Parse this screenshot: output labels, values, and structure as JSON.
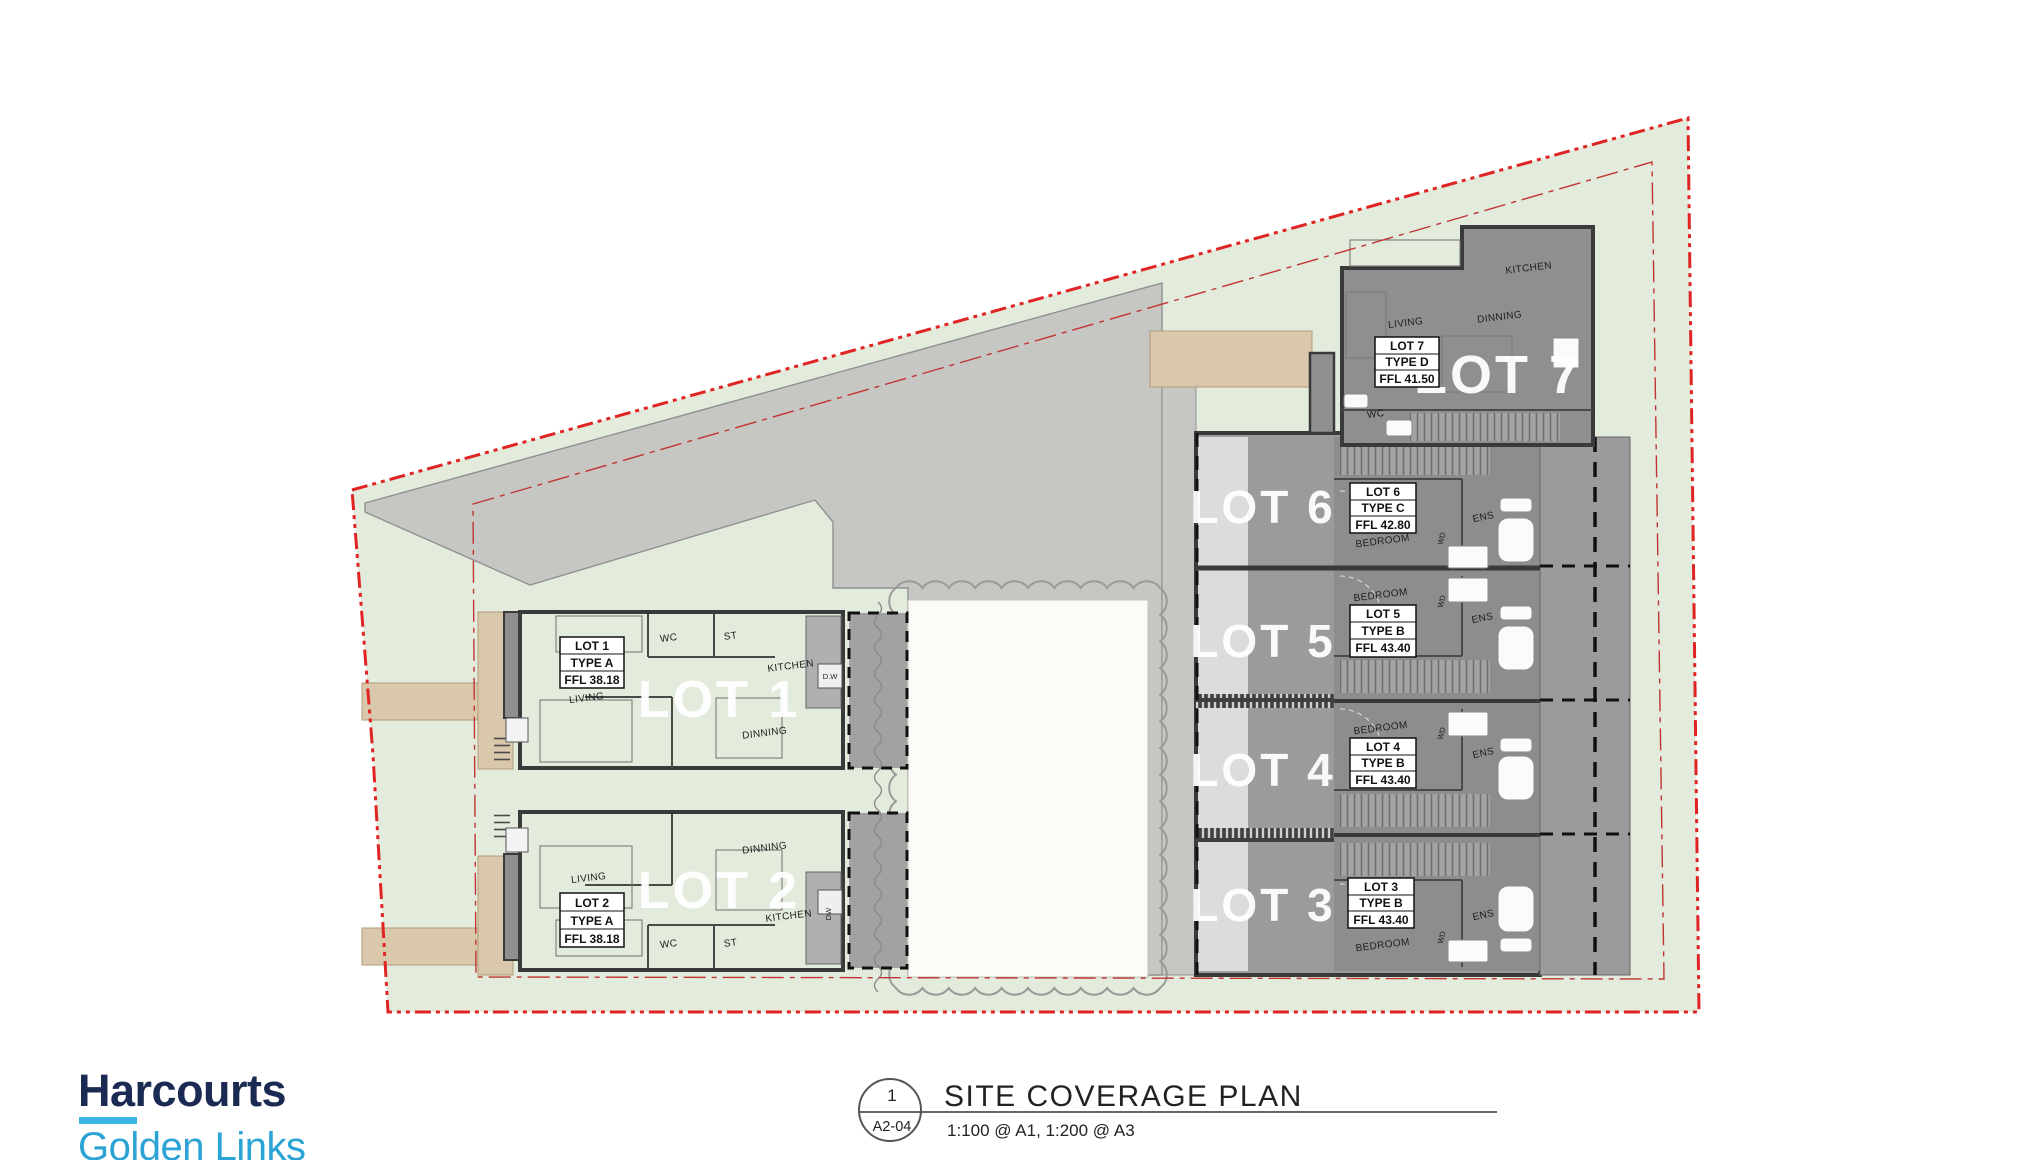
{
  "branding": {
    "brand": "Harcourts",
    "office": "Golden Links"
  },
  "title_block": {
    "detail_number": "1",
    "sheet_number": "A2-04",
    "title": "SITE COVERAGE PLAN",
    "scale": "1:100 @ A1, 1:200 @ A3"
  },
  "lots": [
    {
      "name": "LOT 1",
      "type": "TYPE A",
      "ffl": "FFL 38.18",
      "rooms": {
        "wc": "WC",
        "st": "ST",
        "kitchen": "KITCHEN",
        "dw": "D.W",
        "living": "LIVING",
        "dinning": "DINNING"
      }
    },
    {
      "name": "LOT 2",
      "type": "TYPE A",
      "ffl": "FFL 38.18",
      "rooms": {
        "wc": "WC",
        "st": "ST",
        "kitchen": "KITCHEN",
        "dw": "DW",
        "living": "LIVING",
        "dinning": "DINNING"
      }
    },
    {
      "name": "LOT 3",
      "type": "TYPE B",
      "ffl": "FFL 43.40",
      "rooms": {
        "bedroom": "BEDROOM",
        "wd": "WD",
        "ens": "ENS"
      }
    },
    {
      "name": "LOT 4",
      "type": "TYPE B",
      "ffl": "FFL 43.40",
      "rooms": {
        "bedroom": "BEDROOM",
        "wd": "WD",
        "ens": "ENS"
      }
    },
    {
      "name": "LOT 5",
      "type": "TYPE B",
      "ffl": "FFL 43.40",
      "rooms": {
        "bedroom": "BEDROOM",
        "wd": "WD",
        "ens": "ENS"
      }
    },
    {
      "name": "LOT 6",
      "type": "TYPE C",
      "ffl": "FFL 42.80",
      "rooms": {
        "bedroom": "BEDROOM",
        "wd": "WD",
        "ens": "ENS"
      }
    },
    {
      "name": "LOT 7",
      "type": "TYPE D",
      "ffl": "FFL 41.50",
      "rooms": {
        "kitchen": "KITCHEN",
        "living": "LIVING",
        "dinning": "DINNING",
        "wc": "WC"
      }
    }
  ],
  "colors": {
    "brand_navy": "#1b2a53",
    "brand_blue": "#2ba3d4",
    "underline_blue": "#3cb4e5",
    "boundary_red": "#e02424",
    "landscape_green": "#e3ecdc",
    "driveway_grey": "#c6c7c3",
    "building_grey": "#8f8f8f",
    "path_tan": "#d9c8ab"
  }
}
